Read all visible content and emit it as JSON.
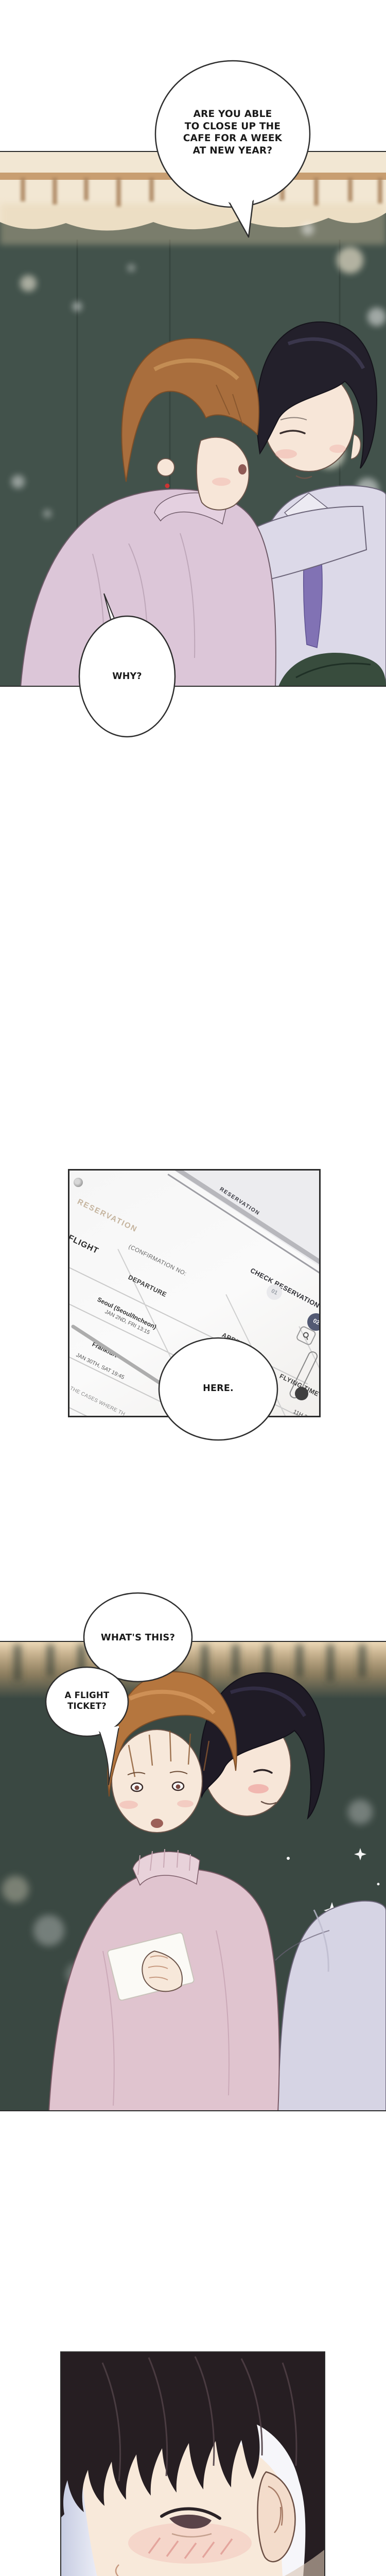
{
  "comic": {
    "panel1": {
      "bubble_question_lines": [
        "ARE YOU ABLE",
        "TO CLOSE UP THE",
        "CAFE FOR A WEEK",
        "AT NEW YEAR?"
      ],
      "bubble_why": "WHY?"
    },
    "panel2": {
      "tab_label": "RESERVATION",
      "bezel_label": "RESERVATION",
      "flight_label": "FLIGHT",
      "confirmation_label": "(CONFIRMATION NO:",
      "check_reservation_label": "CHECK RESERVATION",
      "step_1": "01",
      "step_2": "02",
      "col_airline": "AIRLINE",
      "col_departure": "DEPARTURE",
      "col_arrival": "ARRIVAL",
      "col_flying_time": "FLYING TIME",
      "row1_departure_city": "Seoul (Seoul/Incheon)",
      "row1_departure_time": "JAN 2ND, FRI 13:15",
      "row1_arrival_city": "Frankfurt",
      "row1_arrival_time": "JAN 2ND, FRI 17:45",
      "row1_flying_time": "11H 30M",
      "row2_departure_city": "Frankfurt",
      "row2_departure_time": "JAN 30TH, SAT 19:45",
      "row2_arrival_city": "(Seo",
      "row2_arrival_time": "JAN 30",
      "footnote": "ONLY IN THE CASES WHERE TH",
      "bubble_here": "HERE."
    },
    "panel3": {
      "bubble_whats_this": "WHAT'S THIS?",
      "bubble_ticket_lines": [
        "A FLIGHT",
        "TICKET?"
      ]
    }
  },
  "colors": {
    "panel_border": "#2b2b2b",
    "panel1_bg": "#42524b",
    "panel3_bg": "#3a4842",
    "top_band_cream": "#f2e7d3",
    "sweater_pink": "#dcc6d8",
    "turtleneck_pink": "#e0c4cf",
    "shirt_lavender": "#dcd9e8",
    "tie_purple": "#8172b4",
    "hair_brown": "#a96e3d",
    "hair_black": "#23202b",
    "skin": "#f7e6d8",
    "step2_badge_bg": "#535a73",
    "reservation_tab": "#c5b49e"
  }
}
